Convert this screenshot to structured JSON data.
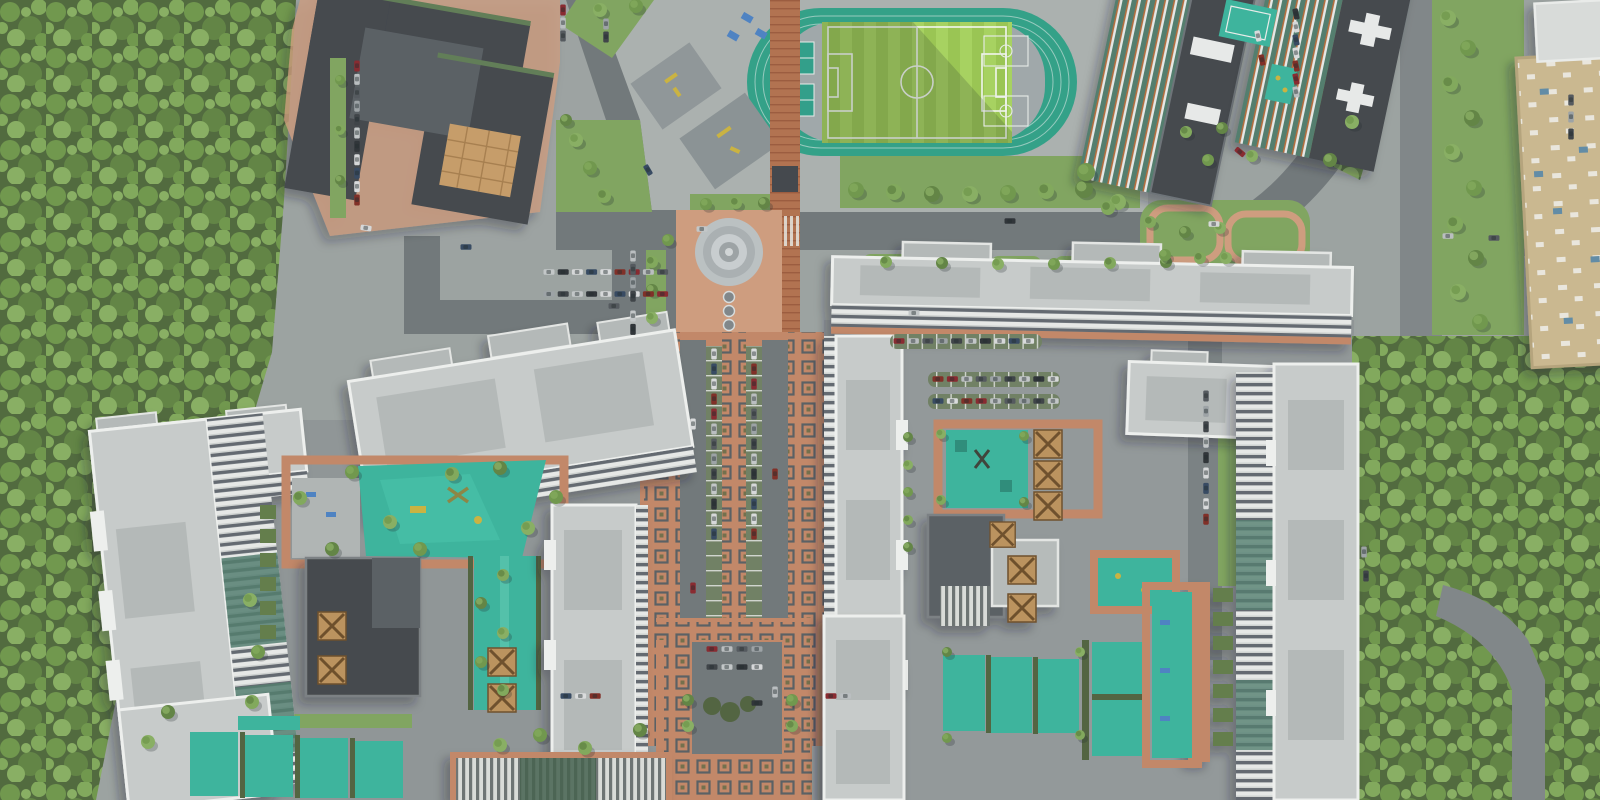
{
  "meta": {
    "title": "Aerial top-down render of a residential complex masterplan",
    "view": "orthographic top-down 3D render, no visible text"
  },
  "palette": {
    "ground": "#99a09e",
    "plaza": "#a9afad",
    "plazadark": "#8d9394",
    "road": "#6e7577",
    "roadlight": "#7d8486",
    "terracotta": "#c08565",
    "terralight": "#cd9a7b",
    "brick": "#b06f4c",
    "motifline": "#565c60",
    "grass": "#7da35c",
    "grassdark": "#5f7a46",
    "hedge": "#4e613c",
    "forestbase": "#4d6739",
    "canopy1": "#6d9549",
    "canopy2": "#7ea758",
    "canopy3": "#5e8240",
    "canopy4": "#86ad5f",
    "teal": "#38b29a",
    "tealdark": "#2d9c87",
    "track": "#2e9e85",
    "pitch1": "#a5d15c",
    "pitch2": "#97c44f",
    "infield": "#9da6a8",
    "rooflight": "#c6cac9",
    "roofinner": "#b2b7b6",
    "parapet": "#edefed",
    "roofdark": "#3f4449",
    "roofdark2": "#565c60",
    "facadewhite": "#e6e8e6",
    "facadewin": "#5f666d",
    "facadeglass": "#4f7a6b",
    "accentorange": "#b06a39",
    "beige": "#c9b68d",
    "skylight": "#5d89a4",
    "bench": "#4a7fc1",
    "equip": "#c9b13c",
    "pergola": "#b9905a",
    "white": "#f2f5ef",
    "shadow": "#1c2426"
  },
  "scene": {
    "regions": [
      {
        "id": "forest-west",
        "label": "dense forest belt"
      },
      {
        "id": "forest-east",
        "label": "dense forest belt"
      },
      {
        "id": "stadium",
        "label": "soccer pitch with running track"
      },
      {
        "id": "school",
        "label": "dark-roof school building"
      },
      {
        "id": "promenade",
        "label": "terracotta promenade with square motifs"
      },
      {
        "id": "fountain-plaza",
        "label": "domed pavilion and fountains"
      },
      {
        "id": "boulevard",
        "label": "central boulevard with median parking"
      },
      {
        "id": "residential-slabs",
        "label": "white residential slab buildings"
      },
      {
        "id": "courtyards",
        "label": "teal playgrounds and sport lawns"
      },
      {
        "id": "mall",
        "label": "beige retail/warehouse roof"
      }
    ],
    "car_colors": [
      "#d8dadb",
      "#2b3034",
      "#9aa0a4",
      "#86252b",
      "#32465e",
      "#c2c6c7",
      "#50555a",
      "#7d2a22",
      "#d5d7d8",
      "#3a3f44",
      "#b8bcbe"
    ],
    "parking": {
      "rows": [
        {
          "x": 357,
          "y": 66,
          "a": 90,
          "n": 11,
          "g": 13.4
        },
        {
          "x": 563,
          "y": 10,
          "a": 90,
          "n": 3,
          "g": 13
        },
        {
          "x": 606,
          "y": 24,
          "a": 90,
          "n": 2,
          "g": 13
        },
        {
          "x": 549,
          "y": 272,
          "a": 0,
          "n": 9,
          "g": 14.2
        },
        {
          "x": 549,
          "y": 294,
          "a": 0,
          "n": 9,
          "g": 14.2
        },
        {
          "x": 633,
          "y": 256,
          "a": 90,
          "n": 4,
          "g": 13.4
        },
        {
          "x": 633,
          "y": 316,
          "a": 90,
          "n": 2,
          "g": 13.4
        },
        {
          "x": 714,
          "y": 354,
          "a": 90,
          "n": 13,
          "g": 15
        },
        {
          "x": 754,
          "y": 354,
          "a": 90,
          "n": 13,
          "g": 15
        },
        {
          "x": 899,
          "y": 341,
          "a": 0,
          "n": 10,
          "g": 14.4
        },
        {
          "x": 938,
          "y": 379,
          "a": 0,
          "n": 9,
          "g": 14.4
        },
        {
          "x": 938,
          "y": 401,
          "a": 0,
          "n": 9,
          "g": 14.4
        },
        {
          "x": 1296,
          "y": 14,
          "a": 78,
          "n": 7,
          "g": 13
        },
        {
          "x": 1206,
          "y": 396,
          "a": 90,
          "n": 9,
          "g": 15.4
        },
        {
          "x": 712,
          "y": 649,
          "a": 0,
          "n": 4,
          "g": 15
        },
        {
          "x": 712,
          "y": 667,
          "a": 0,
          "n": 4,
          "g": 15
        },
        {
          "x": 566,
          "y": 696,
          "a": 0,
          "n": 3,
          "g": 14.6
        },
        {
          "x": 831,
          "y": 696,
          "a": 0,
          "n": 2,
          "g": 14.6
        },
        {
          "x": 1571,
          "y": 100,
          "a": 90,
          "n": 3,
          "g": 17
        }
      ],
      "singles": [
        [
          702,
          229,
          0
        ],
        [
          1010,
          221,
          0
        ],
        [
          1214,
          224,
          0
        ],
        [
          648,
          170,
          60
        ],
        [
          693,
          424,
          90
        ],
        [
          775,
          474,
          90
        ],
        [
          693,
          588,
          90
        ],
        [
          775,
          692,
          90
        ],
        [
          614,
          306,
          0
        ],
        [
          1364,
          552,
          90
        ],
        [
          1366,
          576,
          90
        ],
        [
          914,
          313,
          0
        ],
        [
          757,
          703,
          0
        ],
        [
          366,
          228,
          9
        ],
        [
          466,
          247,
          0
        ],
        [
          1258,
          36,
          78
        ],
        [
          1262,
          60,
          78
        ],
        [
          1240,
          152,
          40
        ],
        [
          1448,
          236,
          0
        ],
        [
          1494,
          238,
          0
        ]
      ]
    },
    "trees": [
      [
        856,
        190,
        8
      ],
      [
        894,
        192,
        8
      ],
      [
        932,
        194,
        8
      ],
      [
        970,
        194,
        8
      ],
      [
        1008,
        193,
        8
      ],
      [
        1046,
        191,
        8
      ],
      [
        1084,
        189,
        9
      ],
      [
        1118,
        202,
        8
      ],
      [
        706,
        204,
        6
      ],
      [
        736,
        203,
        6
      ],
      [
        764,
        203,
        6
      ],
      [
        576,
        140,
        7
      ],
      [
        590,
        168,
        7
      ],
      [
        604,
        196,
        7
      ],
      [
        566,
        120,
        6
      ],
      [
        600,
        10,
        7
      ],
      [
        636,
        6,
        7
      ],
      [
        652,
        262,
        6
      ],
      [
        652,
        290,
        6
      ],
      [
        652,
        318,
        6
      ],
      [
        668,
        240,
        6
      ],
      [
        886,
        262,
        6
      ],
      [
        942,
        263,
        6
      ],
      [
        998,
        264,
        6
      ],
      [
        1054,
        264,
        6
      ],
      [
        1110,
        263,
        6
      ],
      [
        1166,
        262,
        6
      ],
      [
        1226,
        258,
        6
      ],
      [
        352,
        472,
        7
      ],
      [
        300,
        498,
        7
      ],
      [
        332,
        549,
        7
      ],
      [
        390,
        522,
        7
      ],
      [
        420,
        549,
        7
      ],
      [
        452,
        474,
        7
      ],
      [
        500,
        468,
        7
      ],
      [
        528,
        528,
        7
      ],
      [
        556,
        497,
        7
      ],
      [
        503,
        575,
        6
      ],
      [
        481,
        603,
        6
      ],
      [
        503,
        633,
        6
      ],
      [
        481,
        662,
        6
      ],
      [
        503,
        690,
        6
      ],
      [
        908,
        437,
        5
      ],
      [
        908,
        465,
        5
      ],
      [
        908,
        492,
        5
      ],
      [
        908,
        520,
        5
      ],
      [
        908,
        547,
        5
      ],
      [
        941,
        434,
        5
      ],
      [
        1024,
        436,
        5
      ],
      [
        941,
        500,
        5
      ],
      [
        1024,
        502,
        5
      ],
      [
        1448,
        18,
        8
      ],
      [
        1468,
        48,
        8
      ],
      [
        1450,
        84,
        8
      ],
      [
        1472,
        118,
        8
      ],
      [
        1452,
        152,
        8
      ],
      [
        1474,
        188,
        8
      ],
      [
        1455,
        224,
        8
      ],
      [
        1476,
        258,
        8
      ],
      [
        1458,
        292,
        8
      ],
      [
        1480,
        322,
        8
      ],
      [
        1150,
        222,
        6
      ],
      [
        1185,
        232,
        6
      ],
      [
        1220,
        228,
        6
      ],
      [
        1165,
        255,
        6
      ],
      [
        1200,
        258,
        6
      ],
      [
        688,
        700,
        6
      ],
      [
        688,
        726,
        6
      ],
      [
        792,
        700,
        6
      ],
      [
        792,
        726,
        6
      ],
      [
        947,
        652,
        5
      ],
      [
        1080,
        652,
        5
      ],
      [
        947,
        738,
        5
      ],
      [
        1080,
        735,
        5
      ],
      [
        1222,
        128,
        6
      ],
      [
        1252,
        156,
        6
      ],
      [
        1208,
        160,
        6
      ],
      [
        1186,
        132,
        6
      ],
      [
        168,
        712,
        7
      ],
      [
        148,
        742,
        7
      ],
      [
        340,
        80,
        5
      ],
      [
        340,
        130,
        5
      ],
      [
        340,
        180,
        5
      ],
      [
        500,
        745,
        7
      ],
      [
        540,
        735,
        7
      ],
      [
        585,
        748,
        7
      ],
      [
        640,
        730,
        7
      ],
      [
        250,
        600,
        7
      ],
      [
        258,
        652,
        7
      ],
      [
        252,
        702,
        7
      ],
      [
        1330,
        160,
        7
      ],
      [
        1352,
        122,
        7
      ],
      [
        1086,
        172,
        9
      ],
      [
        1108,
        208,
        7
      ]
    ]
  }
}
